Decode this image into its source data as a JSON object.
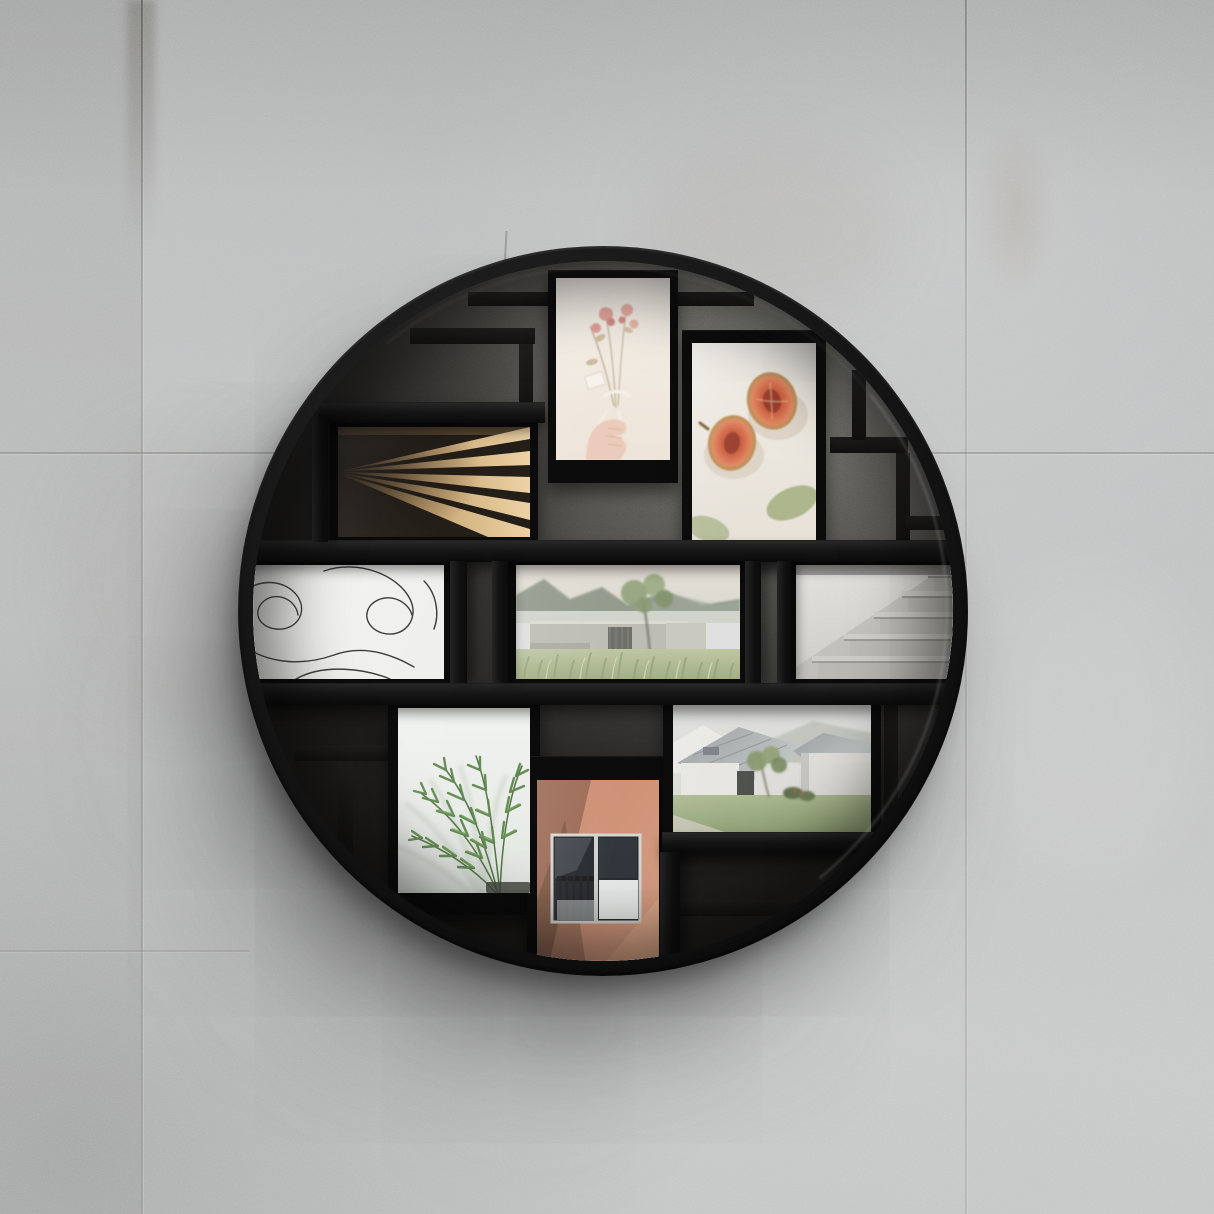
{
  "scene": {
    "type": "product-photograph",
    "description": "Round black multi-opening collage photo frame mounted on a gray concrete panel wall",
    "lighting": "soft daylight from upper right, soft shadow cast to lower left of the frame"
  },
  "wall": {
    "base_color": "#bcbdbe",
    "texture": "fine concrete grain with faint stains",
    "seams": {
      "vertical_x": [
        141,
        965
      ],
      "horizontal_y": [
        452
      ],
      "stain_top_of_left_seam": true
    }
  },
  "frame": {
    "shape": "circle",
    "color": "#121212",
    "outer_diameter_px": 730,
    "center_x_px": 603,
    "center_y_px": 611,
    "rim_thickness_px": 16,
    "interior": "shadowed concrete seen through black shelf lattice",
    "structure": "two full-width shelves with vertical dividers holding nine photos"
  },
  "photos": [
    {
      "id": "wood-slats",
      "label": "Sunlit wooden slats fanning diagonally",
      "palette": [
        "#dcb886",
        "#241e18"
      ]
    },
    {
      "id": "dried-bouquet",
      "label": "Hand holding a dried flower bouquet",
      "palette": [
        "#f3ede5",
        "#e09a90",
        "#e9c6b4"
      ]
    },
    {
      "id": "fig-halves",
      "label": "Two halved figs with eucalyptus leaves",
      "palette": [
        "#eeebe4",
        "#c9593a",
        "#a9b287"
      ]
    },
    {
      "id": "line-art",
      "label": "Abstract continuous line drawing",
      "palette": [
        "#f2f2f0",
        "#3e3e3e"
      ]
    },
    {
      "id": "landscape",
      "label": "Concrete building with tree, mountains and tall grass",
      "palette": [
        "#dcd8cd",
        "#b9b8af",
        "#9dab7c"
      ]
    },
    {
      "id": "stone-stairs",
      "label": "Granite staircase ascending to the right",
      "palette": [
        "#e9e8e4",
        "#c2c0ba"
      ]
    },
    {
      "id": "palm-plant",
      "label": "Palm fronds against a white wall",
      "palette": [
        "#eef0ed",
        "#568244"
      ]
    },
    {
      "id": "terracotta-window",
      "label": "Window with balcony railing on a terracotta wall",
      "palette": [
        "#c98a6e",
        "#23262a",
        "#e9ebea"
      ]
    },
    {
      "id": "white-house",
      "label": "White gabled house with metal roof and lawn",
      "palette": [
        "#e6e5e0",
        "#9ca1a3",
        "#8ca072"
      ]
    }
  ],
  "shadow": {
    "direction": "lower-left",
    "softness": "large and diffuse",
    "color": "#3c3c3c"
  }
}
